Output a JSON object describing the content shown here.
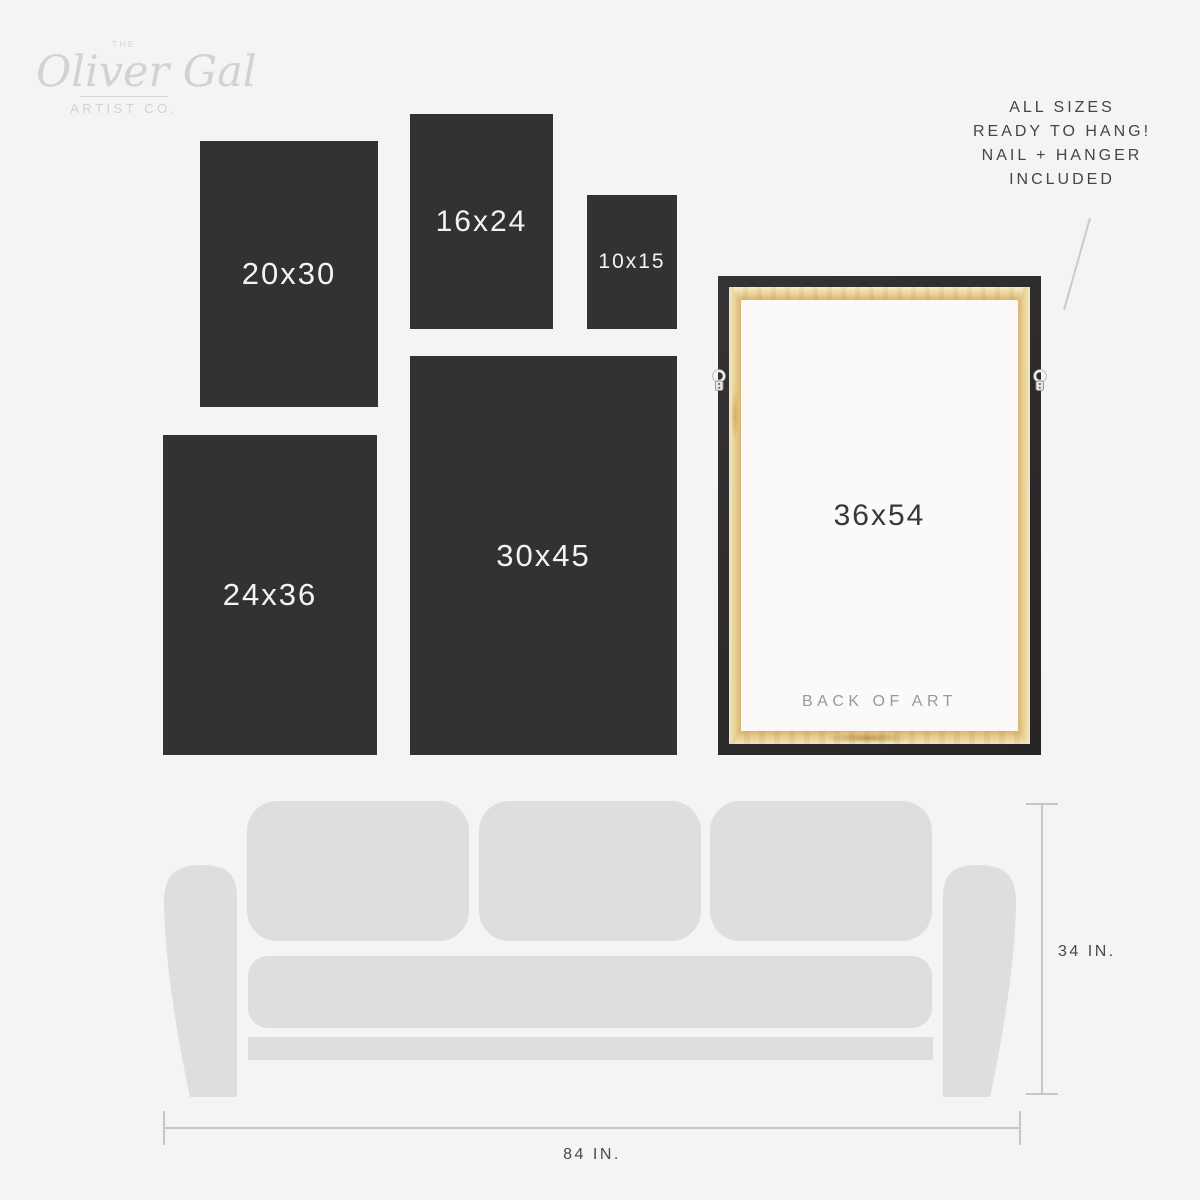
{
  "brand": {
    "prefix": "THE",
    "name": "Oliver Gal",
    "suffix": "ARTIST CO."
  },
  "note": {
    "lines": [
      "ALL SIZES",
      "READY TO HANG!",
      "NAIL + HANGER",
      "INCLUDED"
    ]
  },
  "sizes": [
    {
      "label": "20x30",
      "width_in": 20,
      "height_in": 30
    },
    {
      "label": "16x24",
      "width_in": 16,
      "height_in": 24
    },
    {
      "label": "10x15",
      "width_in": 10,
      "height_in": 15
    },
    {
      "label": "24x36",
      "width_in": 24,
      "height_in": 36
    },
    {
      "label": "30x45",
      "width_in": 30,
      "height_in": 45
    },
    {
      "label": "36x54",
      "width_in": 36,
      "height_in": 54
    }
  ],
  "frame": {
    "back_label": "BACK OF ART"
  },
  "couch": {
    "height_label": "34 IN.",
    "width_label": "84 IN."
  },
  "colors": {
    "background": "#f5f4f2",
    "panel": "#343132",
    "panel_text": "#f4f3f2",
    "couch": "#dfdede",
    "frame_black": "#2c2a2b",
    "wood_light": "#f4e8c0",
    "wood_dark": "#d8b571",
    "canvas_back": "#fbfaf8",
    "dimension_line": "#c8c7c5",
    "dimension_text": "#4c4a49",
    "note_text": "#474645",
    "logo_text": "#d4d2d0",
    "back_of_art_text": "#9b9998"
  }
}
